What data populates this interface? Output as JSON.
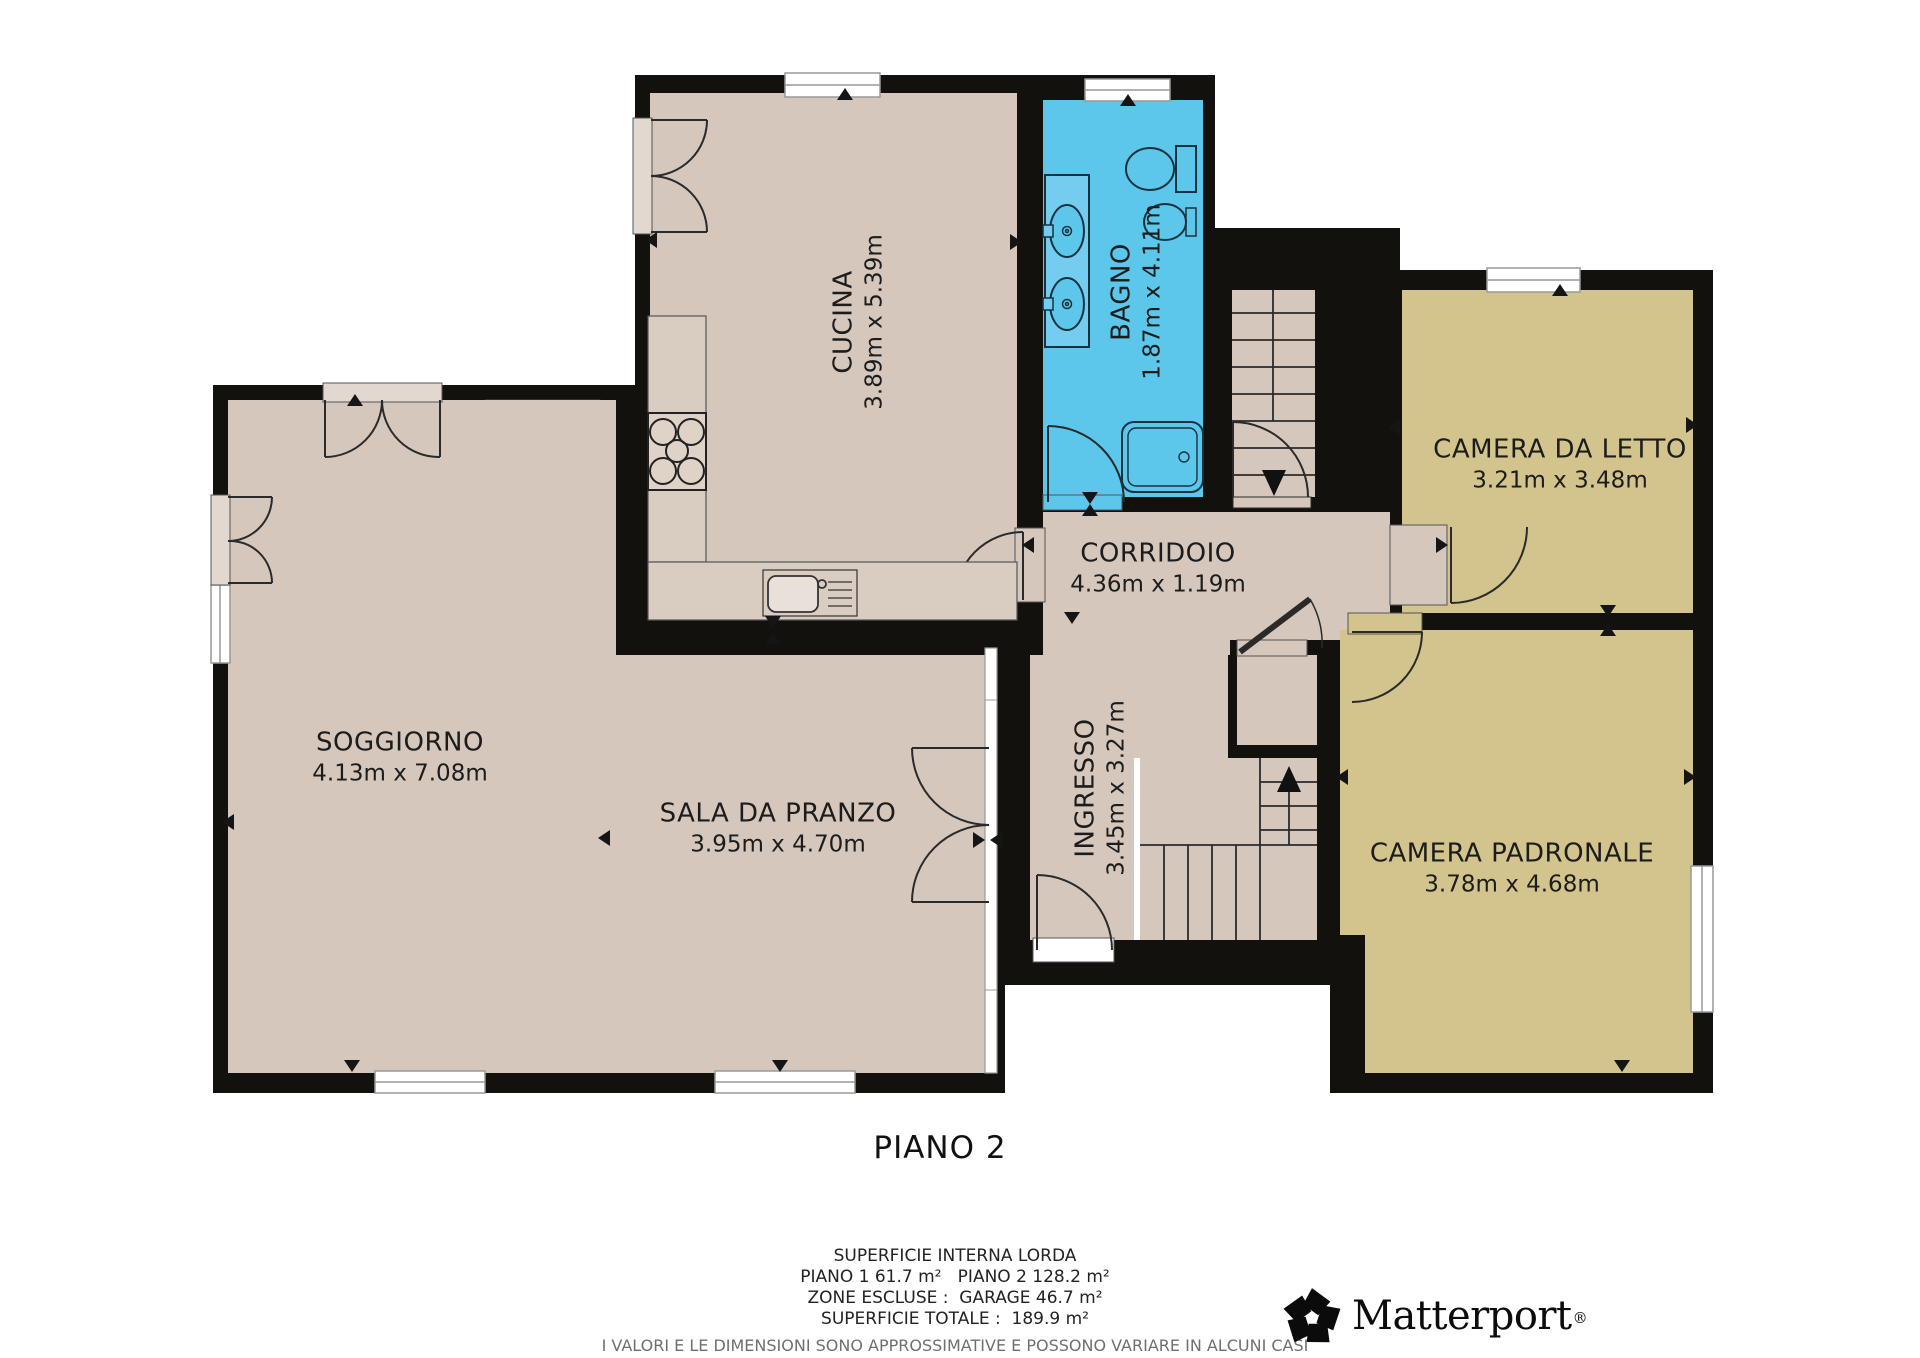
{
  "title": {
    "floor_label": "PIANO 2"
  },
  "rooms": {
    "cucina": {
      "name": "CUCINA",
      "dims": "3.89m x 5.39m"
    },
    "bagno": {
      "name": "BAGNO",
      "dims": "1.87m x 4.11m"
    },
    "camera_da_letto": {
      "name": "CAMERA DA LETTO",
      "dims": "3.21m x 3.48m"
    },
    "corridoio": {
      "name": "CORRIDOIO",
      "dims": "4.36m x 1.19m"
    },
    "soggiorno": {
      "name": "SOGGIORNO",
      "dims": "4.13m x 7.08m"
    },
    "sala_da_pranzo": {
      "name": "SALA DA PRANZO",
      "dims": "3.95m x 4.70m"
    },
    "ingresso": {
      "name": "INGRESSO",
      "dims": "3.45m x 3.27m"
    },
    "camera_padronale": {
      "name": "CAMERA PADRONALE",
      "dims": "3.78m x 4.68m"
    }
  },
  "summary": {
    "line1": "SUPERFICIE INTERNA LORDA",
    "line2": "PIANO 1 61.7 m²   PIANO 2 128.2 m²",
    "line3": "ZONE ESCLUSE :  GARAGE 46.7 m²",
    "line4": "SUPERFICIE TOTALE :  189.9 m²",
    "disclaimer": "I VALORI E LE DIMENSIONI SONO APPROSSIMATIVE E POSSONO VARIARE IN ALCUNI CASI"
  },
  "brand": {
    "name": "Matterport",
    "registered": "®"
  },
  "colors": {
    "wall": "#13110e",
    "floor": "#d5c7bc",
    "bedroom": "#d2c48c",
    "bathroom": "#5dc7eb",
    "counter": "#d9ccc1",
    "door_frame": "#e3d8cf",
    "window": "#ffffff"
  }
}
